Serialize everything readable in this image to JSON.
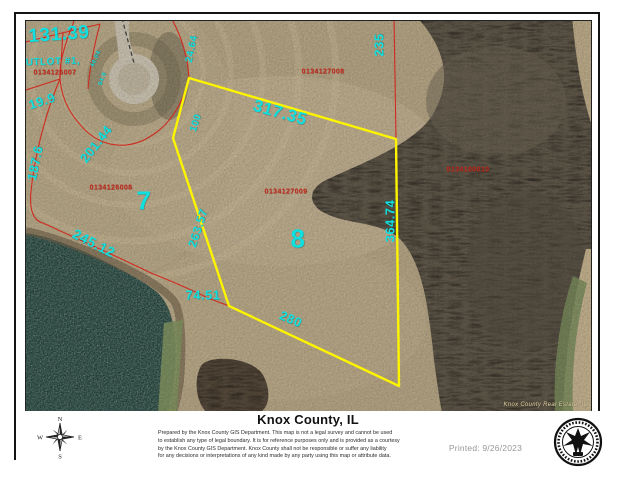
{
  "header": {
    "title": "Knox County, IL"
  },
  "footer": {
    "disclaimer_lines": [
      "Prepared by the Knox County GIS Department. This map is not a legal survey and cannot be used",
      "to establish any type of legal boundary. It is for reference purposes only and is provided as a courtesy",
      "by the Knox County GIS Department. Knox County shall not be responsible or suffer any liability",
      "for any decisions or interpretations of any kind made by any party using this map or attribute data."
    ],
    "printed": "Printed: 9/26/2023",
    "compass": {
      "n": "N",
      "e": "E",
      "s": "S",
      "w": "W"
    }
  },
  "map": {
    "watermark": "Knox County Real Estate, IL",
    "colors": {
      "dimension_text": "#10dfdf",
      "parcel_id_text": "#c3261a",
      "parcel_line": "#cf2b20",
      "selected_boundary": "#fdf400",
      "water": "#24443c",
      "field": "#b2a283",
      "trees": "#5f5749"
    },
    "labels": [
      {
        "text": "131.39",
        "x": 33,
        "y": 14,
        "size": 19,
        "rot": -4,
        "kind": "cyan"
      },
      {
        "text": "UTLOT #1,",
        "x": 27,
        "y": 41,
        "size": 10,
        "rot": -2,
        "kind": "cyan"
      },
      {
        "text": "0134126007",
        "x": 29,
        "y": 52,
        "size": 7,
        "rot": 0,
        "kind": "red"
      },
      {
        "text": "19.9",
        "x": 16,
        "y": 80,
        "size": 13,
        "rot": -18,
        "kind": "cyan"
      },
      {
        "text": "40.04",
        "x": 70,
        "y": 38,
        "size": 6,
        "rot": -65,
        "kind": "cyan"
      },
      {
        "text": "94.9",
        "x": 77,
        "y": 58,
        "size": 6,
        "rot": -70,
        "kind": "cyan"
      },
      {
        "text": "24.64",
        "x": 166,
        "y": 28,
        "size": 10,
        "rot": -78,
        "kind": "cyan"
      },
      {
        "text": "235",
        "x": 353,
        "y": 24,
        "size": 13,
        "rot": -90,
        "kind": "cyan"
      },
      {
        "text": "317.35",
        "x": 254,
        "y": 92,
        "size": 17,
        "rot": 16,
        "kind": "cyan"
      },
      {
        "text": "0134127008",
        "x": 297,
        "y": 51,
        "size": 7,
        "rot": 0,
        "kind": "red"
      },
      {
        "text": "201.44",
        "x": 70,
        "y": 123,
        "size": 13,
        "rot": -52,
        "kind": "cyan"
      },
      {
        "text": "187.6",
        "x": 9,
        "y": 142,
        "size": 13,
        "rot": -78,
        "kind": "cyan"
      },
      {
        "text": "100",
        "x": 170,
        "y": 102,
        "size": 10,
        "rot": -72,
        "kind": "cyan"
      },
      {
        "text": "0134126008",
        "x": 85,
        "y": 167,
        "size": 7,
        "rot": 0,
        "kind": "red"
      },
      {
        "text": "7",
        "x": 118,
        "y": 180,
        "size": 26,
        "rot": 0,
        "kind": "cyan"
      },
      {
        "text": "0134127009",
        "x": 260,
        "y": 171,
        "size": 7,
        "rot": 0,
        "kind": "red"
      },
      {
        "text": "0134100010",
        "x": 442,
        "y": 149,
        "size": 7,
        "rot": 0,
        "kind": "red"
      },
      {
        "text": "263.57",
        "x": 172,
        "y": 207,
        "size": 12,
        "rot": -72,
        "kind": "cyan"
      },
      {
        "text": "8",
        "x": 272,
        "y": 218,
        "size": 26,
        "rot": 0,
        "kind": "cyan"
      },
      {
        "text": "364.74",
        "x": 364,
        "y": 200,
        "size": 13,
        "rot": -90,
        "kind": "cyan"
      },
      {
        "text": "245.12",
        "x": 68,
        "y": 222,
        "size": 14,
        "rot": 27,
        "kind": "cyan"
      },
      {
        "text": "74.51",
        "x": 177,
        "y": 274,
        "size": 13,
        "rot": 0,
        "kind": "cyan"
      },
      {
        "text": "280",
        "x": 265,
        "y": 298,
        "size": 13,
        "rot": 23,
        "kind": "cyan"
      }
    ]
  }
}
